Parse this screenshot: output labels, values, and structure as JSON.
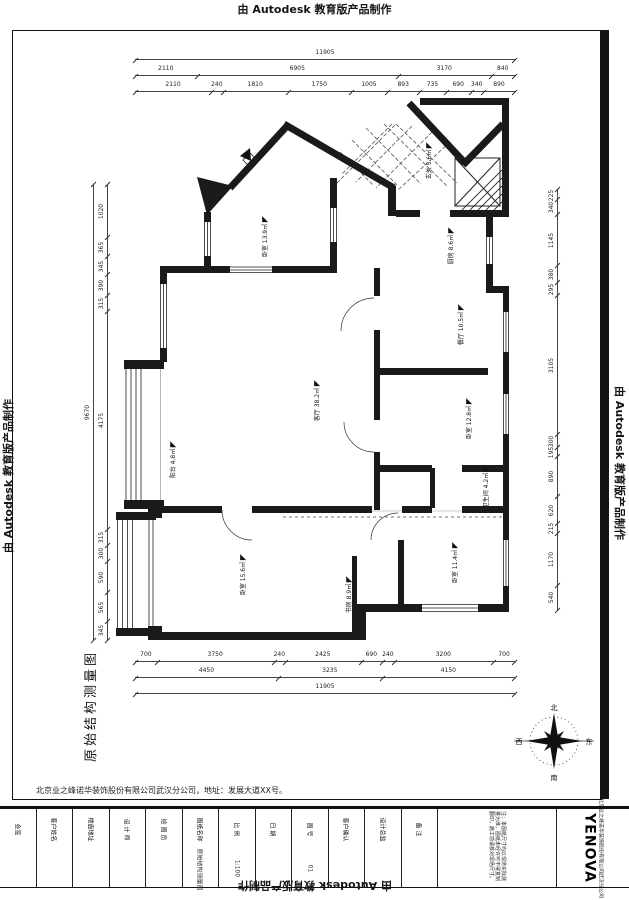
{
  "watermark": {
    "text": "由 Autodesk 教育版产品制作"
  },
  "drawing_title": "原始结构测量图",
  "company_line": "北京业之峰诺华装饰股份有限公司武汉分公司，地址：发展大道XX号。",
  "compass": {
    "north": "北",
    "south": "南",
    "east": "东",
    "west": "西"
  },
  "rooms": [
    {
      "name": "卧室",
      "area": "13.9㎡",
      "x": 244,
      "y": 232
    },
    {
      "name": "玄关",
      "area": "5.6㎡",
      "x": 410,
      "y": 156
    },
    {
      "name": "厨房",
      "area": "8.6㎡",
      "x": 432,
      "y": 241
    },
    {
      "name": "客厅",
      "area": "38.2㎡",
      "x": 296,
      "y": 396
    },
    {
      "name": "阳台",
      "area": "4.8㎡",
      "x": 154,
      "y": 455
    },
    {
      "name": "餐厅",
      "area": "10.5㎡",
      "x": 440,
      "y": 320
    },
    {
      "name": "卧室",
      "area": "12.8㎡",
      "x": 448,
      "y": 414
    },
    {
      "name": "卫生间",
      "area": "4.2㎡",
      "x": 464,
      "y": 482
    },
    {
      "name": "卧室",
      "area": "15.6㎡",
      "x": 222,
      "y": 570
    },
    {
      "name": "书房",
      "area": "8.9㎡",
      "x": 330,
      "y": 590
    },
    {
      "name": "卧室",
      "area": "11.4㎡",
      "x": 434,
      "y": 558
    }
  ],
  "dimensions": {
    "top": {
      "total": "11905",
      "row1": [
        "2110",
        "6905",
        "3170",
        "840"
      ],
      "row2": [
        "2110",
        "240",
        "1810",
        "1750",
        "1005",
        "893",
        "735",
        "690",
        "340",
        "890"
      ]
    },
    "bottom": {
      "row1": [
        "700",
        "3750",
        "240",
        "2425",
        "690",
        "240",
        "3200",
        "700"
      ],
      "row2": [
        "4450",
        "3235",
        "4150"
      ],
      "total": "11905"
    },
    "left": {
      "total": "9670",
      "chain": [
        "1020",
        "365",
        "345",
        "390",
        "315",
        "4175",
        "315",
        "300",
        "590",
        "565",
        "345"
      ]
    },
    "right": {
      "chain": [
        "225",
        "340",
        "1145",
        "380",
        "295",
        "3105",
        "300",
        "195",
        "890",
        "620",
        "215",
        "1170",
        "540"
      ]
    }
  },
  "titleblock": {
    "cells": [
      {
        "label": "会签",
        "value": ""
      },
      {
        "label": "客户姓名",
        "value": ""
      },
      {
        "label": "楼盘地址",
        "value": ""
      },
      {
        "label": "设 计 师",
        "value": ""
      },
      {
        "label": "绘 图 员",
        "value": ""
      },
      {
        "label": "图纸名称",
        "value": "原始结构测量图"
      },
      {
        "label": "比 例",
        "value": "1:100"
      },
      {
        "label": "日 期",
        "value": ""
      },
      {
        "label": "图 号",
        "value": "01"
      },
      {
        "label": "客户确认",
        "value": ""
      },
      {
        "label": "设计总监",
        "value": ""
      },
      {
        "label": "备 注",
        "value": ""
      }
    ],
    "notes": "注：本图纸尺寸均以现场实际测量为准，图纸未经许可不得复制翻印，施工前请核对现场尺寸。",
    "company": "北京业之峰诺华装饰股份有限公司武汉分公司",
    "logo": "YENOVA"
  }
}
